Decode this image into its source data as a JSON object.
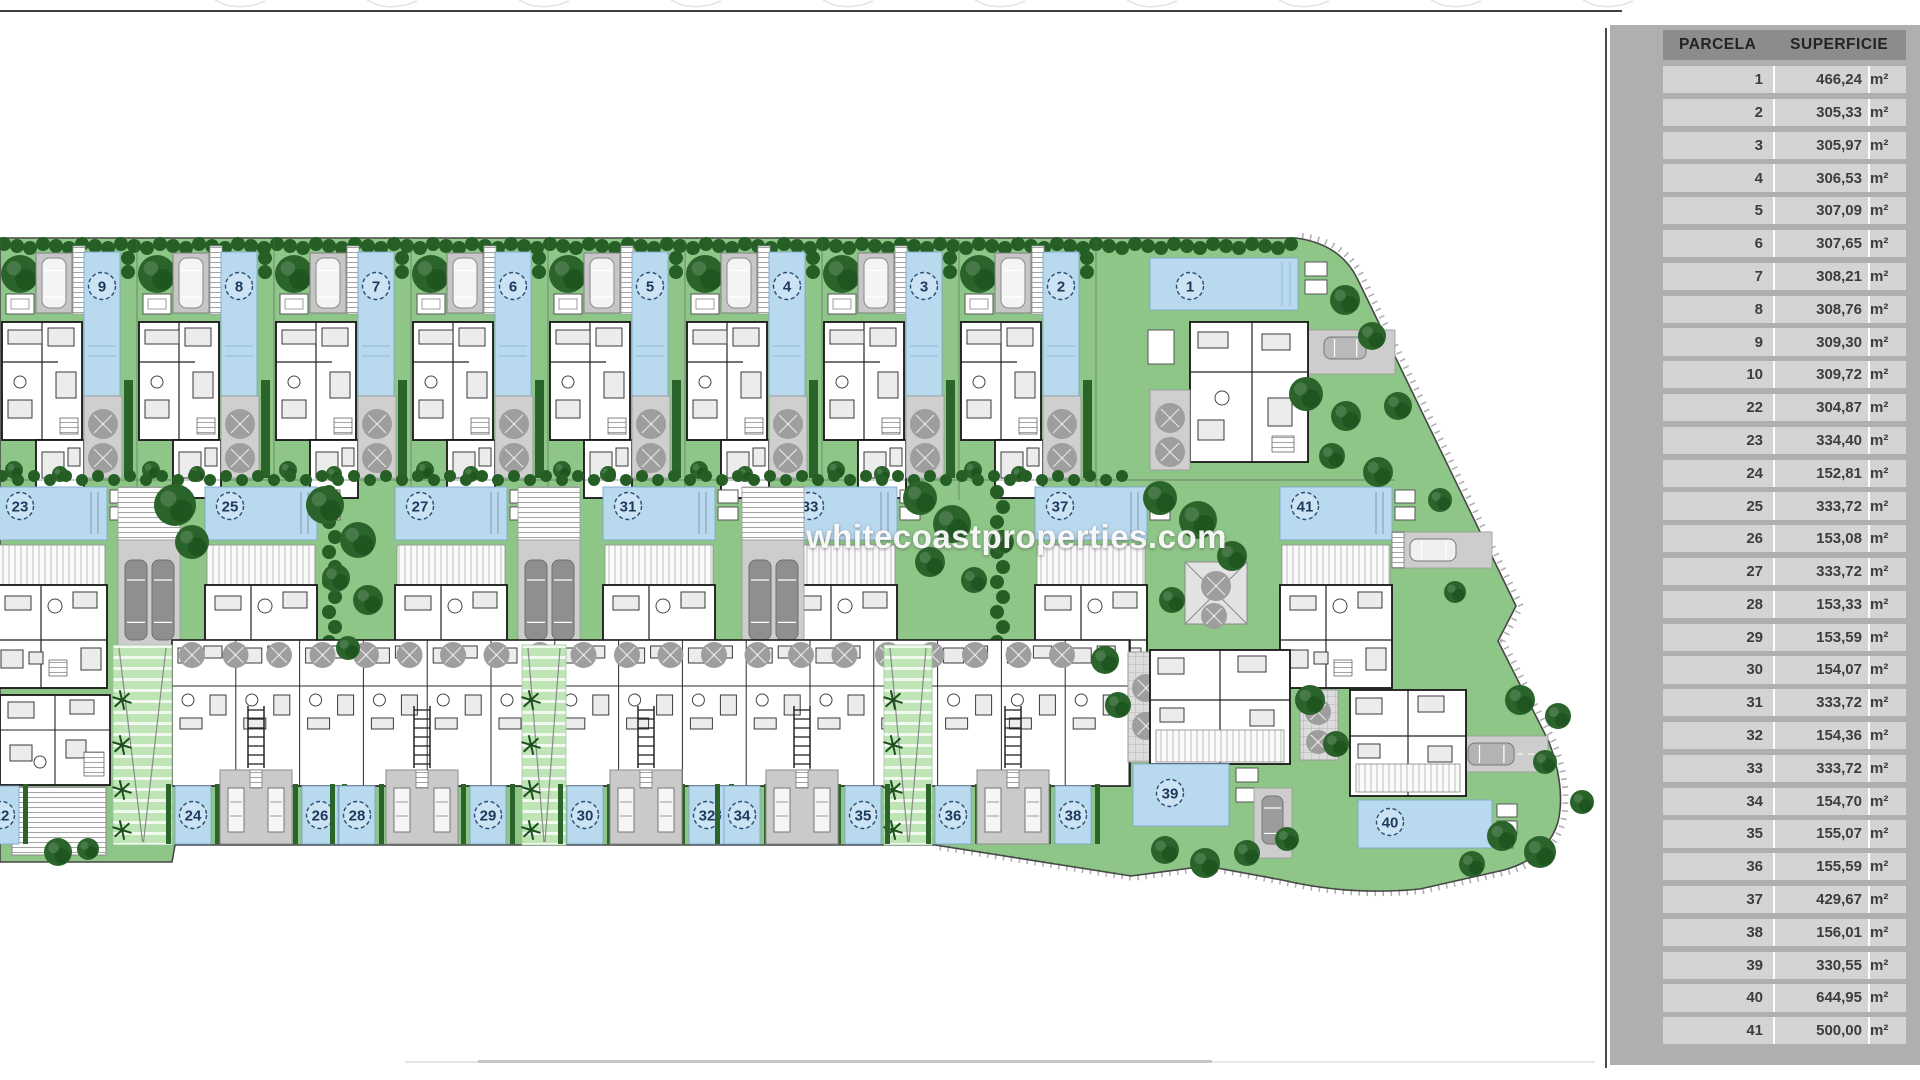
{
  "watermark": "whitecoastproperties.com",
  "table": {
    "headers": [
      "PARCELA",
      "SUPERFICIE"
    ],
    "unit": "m²",
    "rows": [
      [
        "1",
        "466,24"
      ],
      [
        "2",
        "305,33"
      ],
      [
        "3",
        "305,97"
      ],
      [
        "4",
        "306,53"
      ],
      [
        "5",
        "307,09"
      ],
      [
        "6",
        "307,65"
      ],
      [
        "7",
        "308,21"
      ],
      [
        "8",
        "308,76"
      ],
      [
        "9",
        "309,30"
      ],
      [
        "10",
        "309,72"
      ],
      [
        "22",
        "304,87"
      ],
      [
        "23",
        "334,40"
      ],
      [
        "24",
        "152,81"
      ],
      [
        "25",
        "333,72"
      ],
      [
        "26",
        "153,08"
      ],
      [
        "27",
        "333,72"
      ],
      [
        "28",
        "153,33"
      ],
      [
        "29",
        "153,59"
      ],
      [
        "30",
        "154,07"
      ],
      [
        "31",
        "333,72"
      ],
      [
        "32",
        "154,36"
      ],
      [
        "33",
        "333,72"
      ],
      [
        "34",
        "154,70"
      ],
      [
        "35",
        "155,07"
      ],
      [
        "36",
        "155,59"
      ],
      [
        "37",
        "429,67"
      ],
      [
        "38",
        "156,01"
      ],
      [
        "39",
        "330,55"
      ],
      [
        "40",
        "644,95"
      ],
      [
        "41",
        "500,00"
      ]
    ]
  },
  "plan": {
    "top_units": [
      {
        "n": "9",
        "x": 0
      },
      {
        "n": "8",
        "x": 137
      },
      {
        "n": "7",
        "x": 274
      },
      {
        "n": "6",
        "x": 411
      },
      {
        "n": "5",
        "x": 548
      },
      {
        "n": "4",
        "x": 685
      },
      {
        "n": "3",
        "x": 822
      },
      {
        "n": "2",
        "x": 959
      }
    ],
    "villa_1": {
      "n": "1"
    },
    "mid_units": [
      {
        "n": "23",
        "x": -5
      },
      {
        "n": "25",
        "x": 205
      },
      {
        "n": "27",
        "x": 395
      },
      {
        "n": "31",
        "x": 603
      },
      {
        "n": "33",
        "x": 785
      },
      {
        "n": "37",
        "x": 1035
      },
      {
        "n": "41",
        "x": 1280
      }
    ],
    "mid_driveways": [
      118,
      518,
      742
    ],
    "hedge_chains": [
      332,
      1000
    ],
    "bottom_pools": [
      {
        "n": "22",
        "cx": 1
      },
      {
        "n": "24",
        "cx": 193
      },
      {
        "n": "26",
        "cx": 320
      },
      {
        "n": "28",
        "cx": 357
      },
      {
        "n": "29",
        "cx": 488
      },
      {
        "n": "30",
        "cx": 585
      },
      {
        "n": "32",
        "cx": 707
      },
      {
        "n": "34",
        "cx": 742
      },
      {
        "n": "35",
        "cx": 863
      },
      {
        "n": "36",
        "cx": 953
      },
      {
        "n": "38",
        "cx": 1073
      }
    ],
    "garage_pairs": [
      256,
      422,
      646,
      802,
      1013
    ],
    "walkways": [
      [
        113,
        59
      ],
      [
        522,
        44
      ],
      [
        884,
        48
      ]
    ],
    "villa_39": {
      "n": "39"
    },
    "villa_40": {
      "n": "40"
    },
    "trees": [
      [
        175,
        505,
        21
      ],
      [
        192,
        542,
        17
      ],
      [
        325,
        505,
        19
      ],
      [
        358,
        540,
        18
      ],
      [
        336,
        578,
        14
      ],
      [
        368,
        600,
        15
      ],
      [
        348,
        648,
        12
      ],
      [
        920,
        498,
        17
      ],
      [
        952,
        524,
        19
      ],
      [
        930,
        562,
        15
      ],
      [
        974,
        580,
        13
      ],
      [
        1002,
        542,
        12
      ],
      [
        1160,
        498,
        17
      ],
      [
        1198,
        520,
        19
      ],
      [
        1232,
        556,
        15
      ],
      [
        1172,
        600,
        13
      ],
      [
        1345,
        300,
        15
      ],
      [
        1372,
        336,
        14
      ],
      [
        1306,
        394,
        17
      ],
      [
        1346,
        416,
        15
      ],
      [
        1398,
        406,
        14
      ],
      [
        1332,
        456,
        13
      ],
      [
        1378,
        472,
        15
      ],
      [
        1440,
        500,
        12
      ],
      [
        1455,
        592,
        11
      ],
      [
        1105,
        660,
        14
      ],
      [
        1118,
        705,
        13
      ],
      [
        1310,
        700,
        15
      ],
      [
        1336,
        744,
        13
      ],
      [
        1520,
        700,
        15
      ],
      [
        1558,
        716,
        13
      ],
      [
        1545,
        762,
        12
      ],
      [
        1502,
        836,
        15
      ],
      [
        1540,
        852,
        16
      ],
      [
        1472,
        864,
        13
      ],
      [
        1582,
        802,
        12
      ],
      [
        1165,
        850,
        14
      ],
      [
        1205,
        863,
        15
      ],
      [
        1247,
        853,
        13
      ],
      [
        1287,
        839,
        12
      ],
      [
        58,
        852,
        14
      ],
      [
        88,
        849,
        11
      ]
    ],
    "colors": {
      "lawn": "#8dc687",
      "walk": "#bfe4b6",
      "pool": "#b9d9ef",
      "pool_edge": "#7fa8c9",
      "treeDark": "#2a642a",
      "hedge": "#265f26",
      "grayTree": "#9e9e9e",
      "drive": "#cdcdcd",
      "boundary": "#474747",
      "wall": "#161616"
    }
  }
}
